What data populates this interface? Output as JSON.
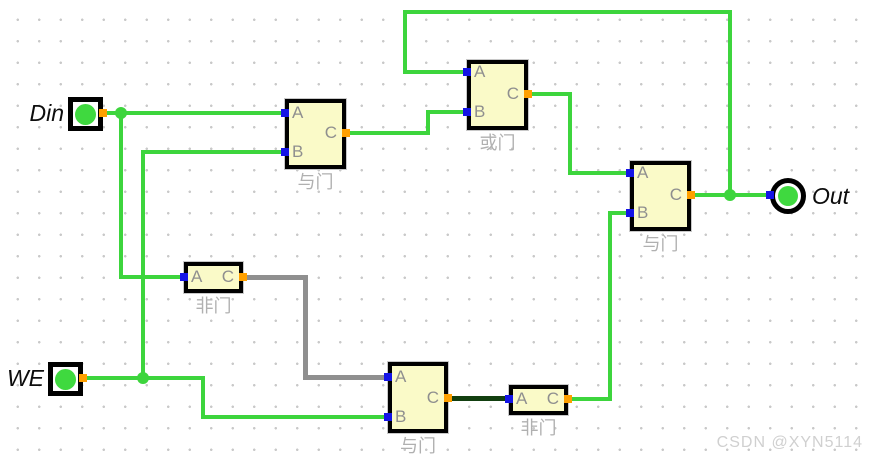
{
  "watermark": "CSDN @XYN5114",
  "colors": {
    "background": "#ffffff",
    "grid_dot": "#c9c9c9",
    "wire_high": "#3dd53d",
    "wire_low": "#123f10",
    "wire_unknown": "#8f8f8f",
    "gate_fill": "#fafac8",
    "gate_border": "#000000",
    "gate_halo": "#c8c8c8",
    "pin_input": "#1414e6",
    "pin_output": "#ffa000",
    "terminal_green": "#3fd93f",
    "pin_label_gray": "#8f8f8f",
    "gate_name_gray": "#b0b0b0",
    "terminal_text": "#0d0d0d",
    "watermark_gray": "#d0d0d0"
  },
  "circuit": {
    "gates": [
      {
        "id": "and-1",
        "name": "与门",
        "x": 285,
        "y": 99,
        "w": 61,
        "h": 70,
        "inputs": [
          {
            "label": "A",
            "y": 113
          },
          {
            "label": "B",
            "y": 152
          }
        ],
        "output": {
          "label": "C",
          "y": 133
        }
      },
      {
        "id": "or-1",
        "name": "或门",
        "x": 467,
        "y": 60,
        "w": 61,
        "h": 70,
        "inputs": [
          {
            "label": "A",
            "y": 72
          },
          {
            "label": "B",
            "y": 112
          }
        ],
        "output": {
          "label": "C",
          "y": 94
        }
      },
      {
        "id": "and-2",
        "name": "与门",
        "x": 630,
        "y": 161,
        "w": 61,
        "h": 70,
        "inputs": [
          {
            "label": "A",
            "y": 173
          },
          {
            "label": "B",
            "y": 213
          }
        ],
        "output": {
          "label": "C",
          "y": 195
        }
      },
      {
        "id": "not-1",
        "name": "非门",
        "x": 184,
        "y": 262,
        "w": 59,
        "h": 31,
        "inputs": [
          {
            "label": "A",
            "y": 277
          }
        ],
        "output": {
          "label": "C",
          "y": 277
        }
      },
      {
        "id": "and-3",
        "name": "与门",
        "x": 388,
        "y": 362,
        "w": 60,
        "h": 71,
        "inputs": [
          {
            "label": "A",
            "y": 377
          },
          {
            "label": "B",
            "y": 417
          }
        ],
        "output": {
          "label": "C",
          "y": 398
        }
      },
      {
        "id": "not-2",
        "name": "非门",
        "x": 509,
        "y": 385,
        "w": 59,
        "h": 30,
        "inputs": [
          {
            "label": "A",
            "y": 399
          }
        ],
        "output": {
          "label": "C",
          "y": 399
        }
      }
    ],
    "terminals": [
      {
        "id": "din",
        "label": "Din",
        "kind": "input",
        "x": 68,
        "y": 97,
        "w": 35,
        "h": 34,
        "pin_y": 113,
        "label_left": 6,
        "label_top": 100,
        "label_w": 58
      },
      {
        "id": "we",
        "label": "WE",
        "kind": "input",
        "x": 48,
        "y": 362,
        "w": 35,
        "h": 34,
        "pin_y": 378,
        "label_left": -14,
        "label_top": 365,
        "label_w": 58
      },
      {
        "id": "out",
        "label": "Out",
        "kind": "output",
        "cx": 788,
        "cy": 196,
        "d": 36,
        "label_left": 812,
        "label_top": 183,
        "label_w": 60
      }
    ],
    "wires": [
      {
        "state": "high",
        "points": [
          [
            103,
            113
          ],
          [
            285,
            113
          ]
        ]
      },
      {
        "state": "high",
        "points": [
          [
            121,
            113
          ],
          [
            121,
            277
          ],
          [
            184,
            277
          ]
        ]
      },
      {
        "state": "high",
        "points": [
          [
            143,
            378
          ],
          [
            143,
            152
          ],
          [
            285,
            152
          ]
        ]
      },
      {
        "state": "high",
        "points": [
          [
            83,
            378
          ],
          [
            203,
            378
          ],
          [
            203,
            417
          ],
          [
            388,
            417
          ]
        ]
      },
      {
        "state": "unknown",
        "points": [
          [
            243,
            277
          ],
          [
            305,
            277
          ],
          [
            305,
            377
          ],
          [
            388,
            377
          ]
        ]
      },
      {
        "state": "high",
        "points": [
          [
            346,
            133
          ],
          [
            428,
            133
          ],
          [
            428,
            112
          ],
          [
            467,
            112
          ]
        ]
      },
      {
        "state": "high",
        "points": [
          [
            528,
            94
          ],
          [
            570,
            94
          ],
          [
            570,
            173
          ],
          [
            630,
            173
          ]
        ]
      },
      {
        "state": "high",
        "points": [
          [
            467,
            72
          ],
          [
            405,
            72
          ],
          [
            405,
            12
          ],
          [
            730,
            12
          ],
          [
            730,
            195
          ]
        ]
      },
      {
        "state": "high",
        "points": [
          [
            691,
            195
          ],
          [
            770,
            195
          ]
        ]
      },
      {
        "state": "low",
        "points": [
          [
            448,
            398
          ],
          [
            509,
            398
          ]
        ]
      },
      {
        "state": "high",
        "points": [
          [
            568,
            399
          ],
          [
            610,
            399
          ],
          [
            610,
            213
          ],
          [
            630,
            213
          ]
        ]
      }
    ],
    "junctions": [
      [
        121,
        113
      ],
      [
        143,
        378
      ],
      [
        730,
        195
      ]
    ]
  }
}
